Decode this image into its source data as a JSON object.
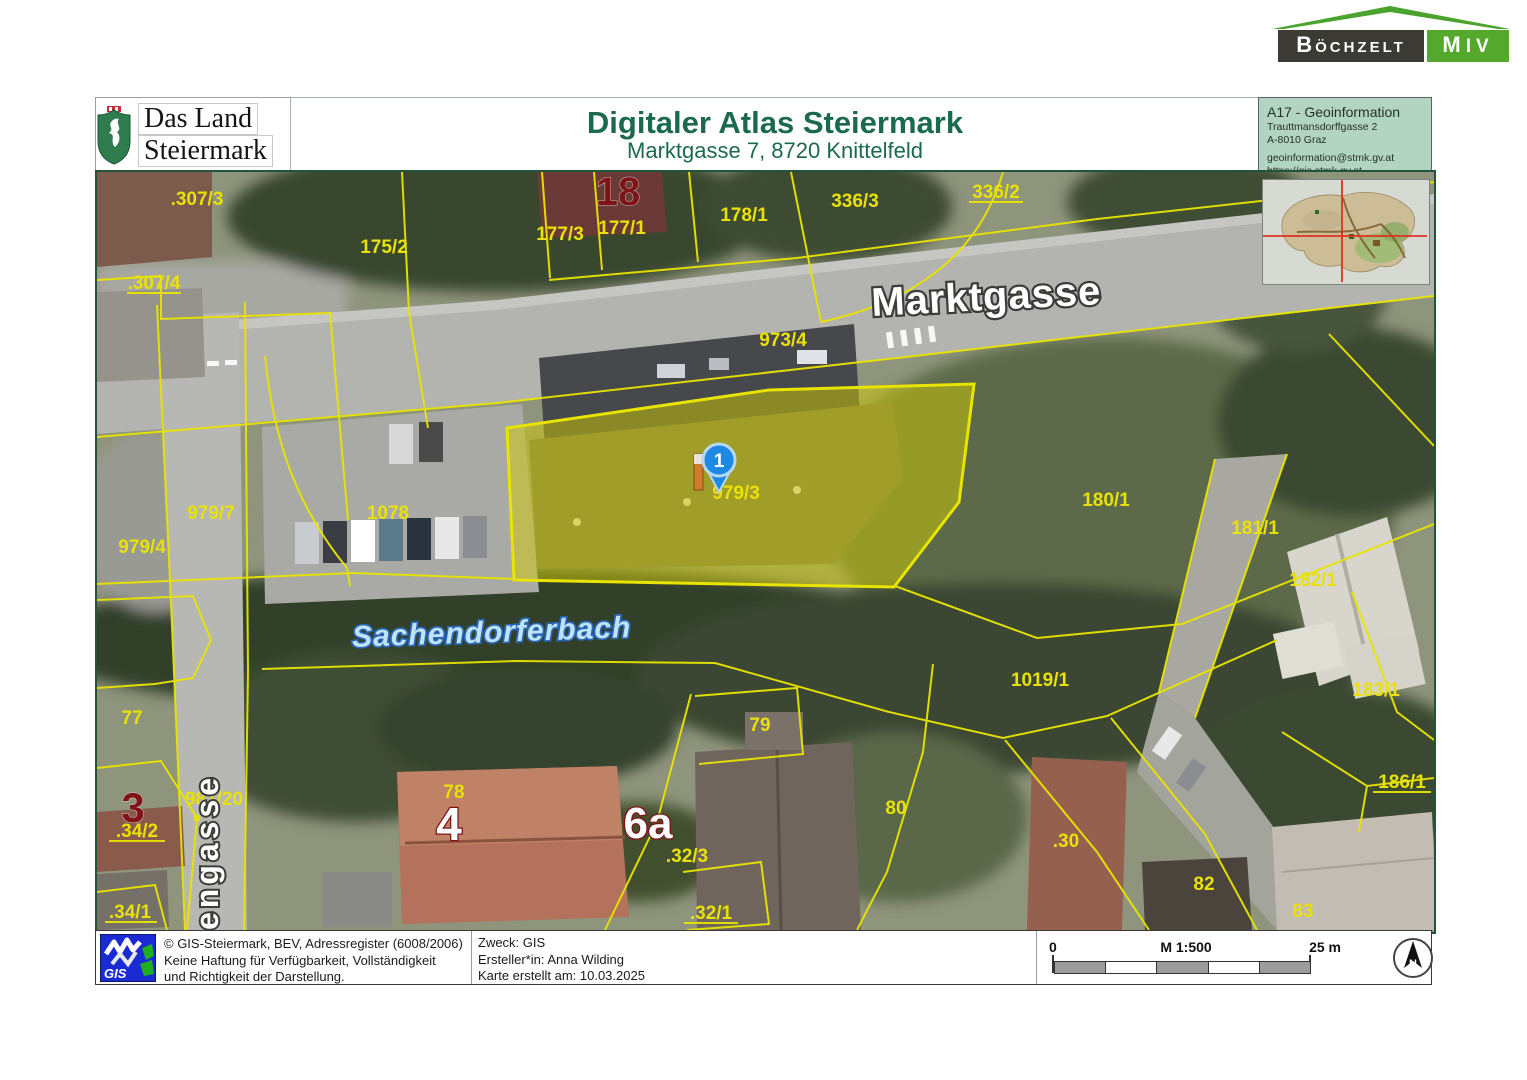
{
  "brand": {
    "left": "Böchzelt",
    "right": "MIV"
  },
  "header": {
    "logo": {
      "line1": "Das Land",
      "line2": "Steiermark"
    },
    "title": "Digitaler Atlas Steiermark",
    "subtitle": "Marktgasse 7, 8720 Knittelfeld",
    "dept": {
      "name": "A17 - Geoinformation",
      "street": "Trauttmansdorffgasse 2",
      "city": "A-8010 Graz",
      "email": "geoinformation@stmk.gv.at",
      "web": "https://gis.stmk.gv.at"
    }
  },
  "map": {
    "streets": {
      "main": "Marktgasse",
      "side_vertical": "engasse"
    },
    "stream": "Sachendorferbach",
    "marker": {
      "number": "1"
    },
    "highlight_parcel": "979/3",
    "parcels": [
      {
        "label": ".307/3"
      },
      {
        "label": ".307/4",
        "underline": true
      },
      {
        "label": "175/2"
      },
      {
        "label": "177/3"
      },
      {
        "label": "177/1"
      },
      {
        "label": "178/1"
      },
      {
        "label": "336/3"
      },
      {
        "label": "336/2",
        "underline": true
      },
      {
        "label": "973/4"
      },
      {
        "label": "979/3"
      },
      {
        "label": "979/7"
      },
      {
        "label": "1078"
      },
      {
        "label": "979/4"
      },
      {
        "label": "180/1"
      },
      {
        "label": "181/1"
      },
      {
        "label": "182/1"
      },
      {
        "label": "1019/1"
      },
      {
        "label": "183/1"
      },
      {
        "label": "77"
      },
      {
        "label": "79"
      },
      {
        "label": "981/20"
      },
      {
        "label": ".34/2",
        "underline": true
      },
      {
        "label": "78"
      },
      {
        "label": ".32/3"
      },
      {
        "label": "80"
      },
      {
        "label": ".30"
      },
      {
        "label": "186/1",
        "underline": true
      },
      {
        "label": "82"
      },
      {
        "label": "83"
      },
      {
        "label": ".34/1",
        "underline": true
      },
      {
        "label": ".32/1",
        "underline": true
      }
    ],
    "house_numbers": [
      {
        "label": "18",
        "style": "red"
      },
      {
        "label": "3",
        "style": "red"
      },
      {
        "label": "4",
        "style": "outline"
      },
      {
        "label": "6a",
        "style": "outline"
      }
    ]
  },
  "footer": {
    "logo_text": "GIS",
    "credits": [
      "© GIS-Steiermark, BEV, Adressregister (6008/2006)",
      "Keine Haftung für Verfügbarkeit, Vollständigkeit",
      "und Richtigkeit der Darstellung."
    ],
    "purpose": "Zweck: GIS",
    "creator": "Ersteller*in: Anna Wilding",
    "date": "Karte erstellt am: 10.03.2025",
    "scale": {
      "start": "0",
      "ratio": "M 1:500",
      "end": "25 m"
    },
    "north_letter": "N"
  },
  "colors": {
    "accent_green": "#54a82b",
    "title_green": "#1c6a4e",
    "parcel_yellow": "#e8e107",
    "marker_blue": "#1e88e5",
    "stream_blue": "#bde4fb",
    "dept_bg": "#b2d4c2"
  }
}
